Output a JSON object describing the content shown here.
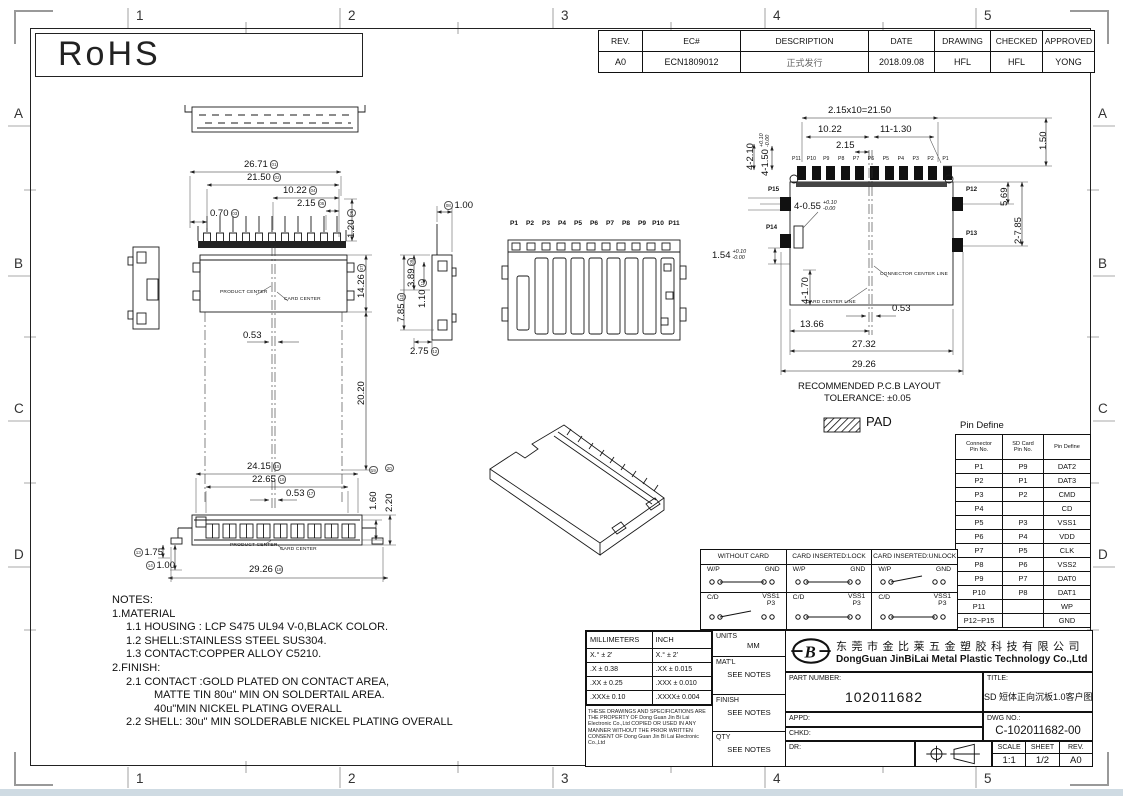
{
  "frame": {
    "col_labels": [
      "1",
      "2",
      "3",
      "4",
      "5"
    ],
    "row_labels": [
      "A",
      "B",
      "C",
      "D"
    ]
  },
  "rohs_label": "RoHS",
  "revision_table": {
    "headers": [
      "REV.",
      "EC#",
      "DESCRIPTION",
      "DATE",
      "DRAWING",
      "CHECKED",
      "APPROVED"
    ],
    "row": [
      "A0",
      "ECN1809012",
      "正式发行",
      "2018.09.08",
      "HFL",
      "HFL",
      "YONG"
    ]
  },
  "views": {
    "front": {
      "dims": {
        "d1": {
          "v": "26.71",
          "b": "01"
        },
        "d2": {
          "v": "21.50",
          "b": "02"
        },
        "d3": {
          "v": "0.70",
          "b": "03"
        },
        "d4": {
          "v": "10.22",
          "b": "04"
        },
        "d5": {
          "v": "2.15",
          "b": "05"
        },
        "d6": {
          "v": "1.20",
          "b": "06"
        }
      }
    },
    "top": {
      "dims": {
        "d7": {
          "v": "14.26",
          "b": "07"
        },
        "d2020": {
          "v": "20.20"
        },
        "d053": {
          "v": "0.53"
        }
      },
      "product_center": "PRODUCT CENTER",
      "card_center": "CARD CENTER"
    },
    "side": {
      "dims": {
        "d8": {
          "v": "1.00",
          "b": "08"
        },
        "d9": {
          "v": "3.89",
          "b": "09"
        },
        "d10": {
          "v": "7.85",
          "b": "10"
        },
        "d11": {
          "v": "1.10",
          "b": "11"
        },
        "d12": {
          "v": "2.75",
          "b": "12"
        }
      }
    },
    "mid_front": {
      "pins": [
        "P1",
        "P2",
        "P3",
        "P4",
        "P5",
        "P6",
        "P7",
        "P8",
        "P9",
        "P10",
        "P11"
      ]
    },
    "bottom": {
      "dims": {
        "d13": {
          "v": "1.75",
          "b": "13"
        },
        "d14": {
          "v": "1.00",
          "b": "14"
        },
        "d15": {
          "v": "24.15",
          "b": "15"
        },
        "d16": {
          "v": "22.65",
          "b": "16"
        },
        "d17": {
          "v": "0.53",
          "b": "17"
        },
        "d18": {
          "v": "29.26",
          "b": "18"
        },
        "d19": {
          "v": "1.60",
          "b": "19"
        },
        "d20": {
          "v": "2.20",
          "b": "20"
        }
      },
      "product_center": "PRODUCT CENTER",
      "card_center": "CARD CENTER"
    },
    "pcb": {
      "pins_top": [
        "P11",
        "P10",
        "P9",
        "P8",
        "P7",
        "P6",
        "P5",
        "P4",
        "P3",
        "P2",
        "P1"
      ],
      "pin_p15": "P15",
      "pin_p14": "P14",
      "pin_p12": "P12",
      "pin_p13": "P13",
      "dims": {
        "pitch": "2.15x10=21.50",
        "d1022": "10.22",
        "holes": "11-1.30",
        "d215": "2.15",
        "d150": "1.50",
        "d569": "5.69",
        "d2785": "2-7.85",
        "d4210": "4-2.10",
        "d4150": {
          "v": "4-1.50",
          "p": "+0.10",
          "m": "-0.00"
        },
        "d4055": {
          "v": "4-0.55",
          "p": "+0.10",
          "m": "-0.00"
        },
        "d154": {
          "v": "1.54",
          "p": "+0.10",
          "m": "-0.00"
        },
        "d4170": "4-1.70",
        "d053": "0.53",
        "d1366": "13.66",
        "d2732": "27.32",
        "d2926": "29.26"
      },
      "card_center_line": "CARD CENTER LINE",
      "connector_center_line": "CONNECTOR CENTER LINE",
      "note_line1": "RECOMMENDED P.C.B LAYOUT",
      "note_line2": "TOLERANCE: ±0.05",
      "pad_label": "PAD"
    }
  },
  "pin_define": {
    "title": "Pin Define",
    "headers": [
      "Connector\nPin No.",
      "SD Card\nPin No.",
      "Pin Define"
    ],
    "rows": [
      [
        "P1",
        "P9",
        "DAT2"
      ],
      [
        "P2",
        "P1",
        "DAT3"
      ],
      [
        "P3",
        "P2",
        "CMD"
      ],
      [
        "P4",
        "",
        "CD"
      ],
      [
        "P5",
        "P3",
        "VSS1"
      ],
      [
        "P6",
        "P4",
        "VDD"
      ],
      [
        "P7",
        "P5",
        "CLK"
      ],
      [
        "P8",
        "P6",
        "VSS2"
      ],
      [
        "P9",
        "P7",
        "DAT0"
      ],
      [
        "P10",
        "P8",
        "DAT1"
      ],
      [
        "P11",
        "",
        "WP"
      ],
      [
        "P12~P15",
        "",
        "GND"
      ]
    ]
  },
  "switch_table": {
    "columns": [
      {
        "header": "WITHOUT CARD",
        "wp": "closed",
        "cd": "open"
      },
      {
        "header": "CARD INSERTED:LOCK",
        "wp": "closed",
        "cd": "closed"
      },
      {
        "header": "CARD INSERTED:UNLOCK",
        "wp": "open",
        "cd": "closed"
      }
    ],
    "wp_left": "W/P",
    "wp_right": "GND",
    "cd_left": "C/D",
    "cd_right_top": "VSS1",
    "cd_right_bottom": "P3"
  },
  "notes": {
    "title": "NOTES:",
    "lines": [
      {
        "text": "1.MATERIAL",
        "indent": 0
      },
      {
        "text": "1.1 HOUSING : LCP S475 UL94 V-0,BLACK COLOR.",
        "indent": 1
      },
      {
        "text": "1.2 SHELL:STAINLESS STEEL SUS304.",
        "indent": 1
      },
      {
        "text": "1.3 CONTACT:COPPER ALLOY C5210.",
        "indent": 1
      },
      {
        "text": "2.FINISH:",
        "indent": 0
      },
      {
        "text": "2.1 CONTACT :GOLD PLATED ON CONTACT AREA,",
        "indent": 1
      },
      {
        "text": "MATTE TIN 80u\" MIN ON SOLDERTAIL AREA.",
        "indent": 2
      },
      {
        "text": "40u\"MIN NICKEL PLATING OVERALL",
        "indent": 2
      },
      {
        "text": "2.2 SHELL: 30u\" MIN SOLDERABLE NICKEL PLATING OVERALL",
        "indent": 1
      }
    ]
  },
  "title_block": {
    "tol_headers": [
      "MILLIMETERS",
      "INCH"
    ],
    "tol_rows": [
      [
        "X.° ± 2'",
        "X.° ± 2'"
      ],
      [
        ".X ± 0.38",
        ".XX ± 0.015"
      ],
      [
        ".XX ± 0.25",
        ".XXX ± 0.010"
      ],
      [
        ".XXX± 0.10",
        ".XXXX± 0.004"
      ]
    ],
    "disclaimer": "THESE DRAWINGS AND SPECIFICATIONS ARE THE PROPERTY OF Dong Guan Jin Bi Lai Electronic Co.,Ltd COPIED OR USED IN ANY MANNER WITHOUT THE PRIOR WRITTEN CONSENT OF Dong Guan Jin Bi Lai Electronic Co.,Ltd",
    "units_label": "UNITS",
    "units_value": "MM",
    "matl_label": "MAT'L",
    "matl_value": "SEE NOTES",
    "finish_label": "FINISH",
    "finish_value": "SEE NOTES",
    "qty_label": "QTY",
    "qty_value": "SEE NOTES",
    "company_cn": "东莞市金比莱五金塑胶科技有限公司",
    "company_en": "DongGuan JinBiLai Metal Plastic Technology Co.,Ltd",
    "part_number_label": "PART NUMBER:",
    "part_number": "102011682",
    "title_label": "TITLE:",
    "title_value": "SD 短体正向沉板1.0客户图",
    "appd_label": "APPD:",
    "chkd_label": "CHKD:",
    "dr_label": "DR:",
    "dwg_label": "DWG NO.:",
    "dwg_no": "C-102011682-00",
    "scale_label": "SCALE",
    "scale_value": "1:1",
    "sheet_label": "SHEET",
    "sheet_value": "1/2",
    "rev_label": "REV.",
    "rev_value": "A0"
  }
}
